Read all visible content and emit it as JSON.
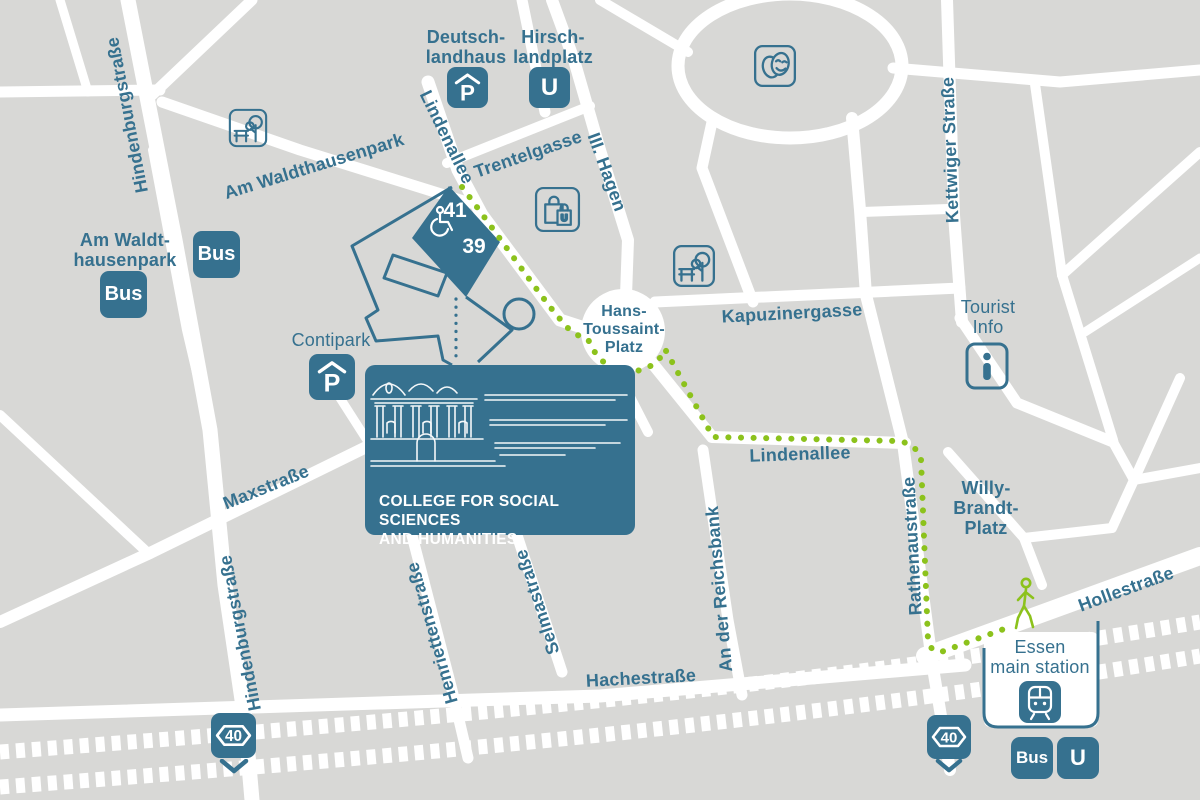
{
  "colors": {
    "background": "#d8d8d6",
    "road": "#ffffff",
    "primary_blue": "#36718f",
    "route_green": "#8cc21c",
    "card_text": "#ffffff"
  },
  "streets": {
    "hindenburgstrasse": "Hindenburgstraße",
    "am_waldthausenpark": "Am Waldthausenpark",
    "lindenallee": "Lindenallee",
    "trentelgasse": "Trentelgasse",
    "iii_hagen": "III. Hagen",
    "kettwiger_strasse": "Kettwiger Straße",
    "kapuzinergasse": "Kapuzinergasse",
    "maxstrasse": "Maxstraße",
    "henriettenstrasse": "Henriettenstraße",
    "selmastrasse": "Selmastraße",
    "hachestrasse": "Hachestraße",
    "an_der_reichsbank": "An der Reichsbank",
    "rathenaustrasse": "Rathenaustraße",
    "hollestrasse": "Hollestraße"
  },
  "places": {
    "deutschlandhaus": [
      "Deutsch-",
      "landhaus"
    ],
    "hirschlandplatz": [
      "Hirsch-",
      "landplatz"
    ],
    "am_waldthausenpark_stop": [
      "Am Waldt-",
      "hausenpark"
    ],
    "hans_toussaint_platz": [
      "Hans-",
      "Toussaint-",
      "Platz"
    ],
    "tourist_info": [
      "Tourist",
      "Info"
    ],
    "willy_brandt_platz": [
      "Willy-",
      "Brandt-",
      "Platz"
    ],
    "contipark": "Contipark",
    "essen_main_station": [
      "Essen",
      "main station"
    ]
  },
  "college": {
    "line1": "COLLEGE FOR SOCIAL SCIENCES",
    "line2": "AND HUMANITIES"
  },
  "building": {
    "number_top": "41",
    "number_bottom": "39"
  },
  "transit": {
    "bus": "Bus",
    "u": "U",
    "parking": "P"
  },
  "motorway": {
    "number": "40"
  },
  "icons": {
    "parking": "P-under-roof",
    "u_bahn": "U-square",
    "bus": "Bus-square",
    "park": "bench-and-tree",
    "theater": "comedy-tragedy-masks",
    "shopping": "shopping-bags-U",
    "tourist_info": "info-i",
    "train": "train-front",
    "wheelchair": "wheelchair-access",
    "pedestrian": "walking-person",
    "motorway_sign": "autobahn-40",
    "direction_chevron": "chevron-down"
  }
}
